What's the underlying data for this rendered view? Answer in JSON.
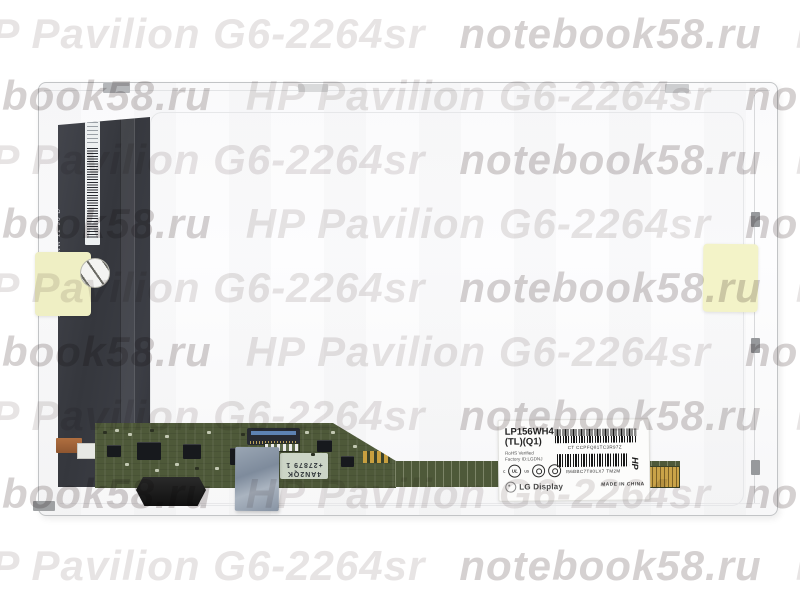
{
  "watermark": {
    "phrase_hp": "HP Pavilion G6-2264sr",
    "phrase_site": "notebook58.ru",
    "color_hp": "#e7e4e4",
    "color_site": "#d5d1d1"
  },
  "panel": {
    "flex_serial_vertical": "55508-29470.62  NW 11 90 D"
  },
  "pcb": {
    "sticker_line1": "4AN2QK",
    "sticker_line2": "+27879 1"
  },
  "label": {
    "model": "LP156WH4",
    "model_suffix": "(TL)(Q1)",
    "rohs_line": "RoHS Verified",
    "factory_line": "Factory ID:LGDNJ",
    "barcode1_text": "CT CCPFQ81TC3R97Z",
    "barcode2_text": "I56BBC7T80LX7 TM2M",
    "hp_mark": "HP",
    "ul_prefix": "c",
    "ul_text": "UL",
    "ul_suffix": "us",
    "brand": "LG Display",
    "made_in": "MADE IN CHINA"
  }
}
